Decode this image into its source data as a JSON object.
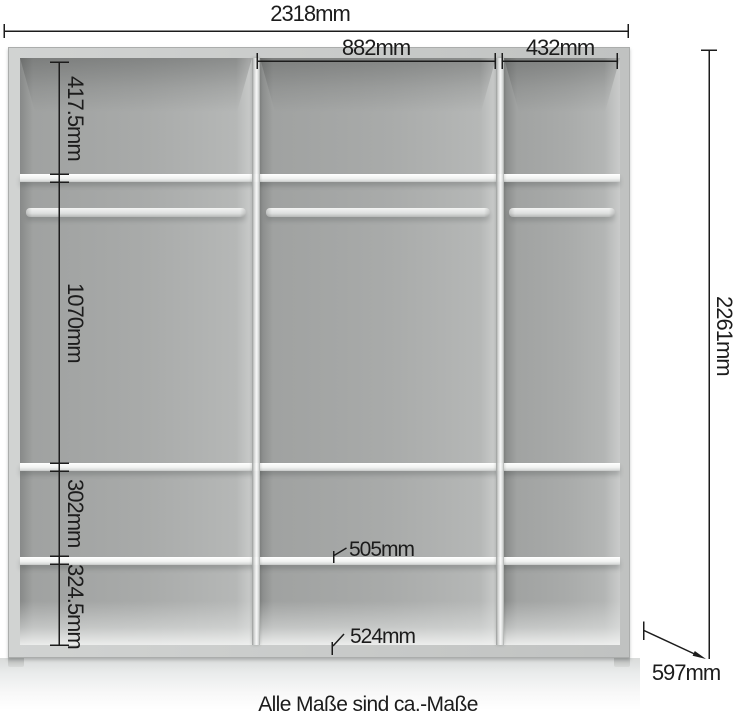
{
  "diagram": {
    "type": "wardrobe-dimension-diagram",
    "note": "Alle Maße sind ca.-Maße"
  },
  "dimensions": {
    "total_width": "2318mm",
    "middle_section_width": "882mm",
    "right_section_width": "432mm",
    "upper_compartment_height": "417.5mm",
    "main_compartment_height": "1070mm",
    "lower_compartment_height": "302mm",
    "bottom_compartment_height": "324.5mm",
    "total_height": "2261mm",
    "depth": "597mm",
    "shelf_clearance_upper": "505mm",
    "shelf_clearance_lower": "524mm"
  },
  "colors": {
    "annotation": "#1c1c1c",
    "frame": "#c9cbca",
    "interior": "#a9abaa",
    "shelf": "#f2f3f2",
    "background": "#ffffff"
  }
}
